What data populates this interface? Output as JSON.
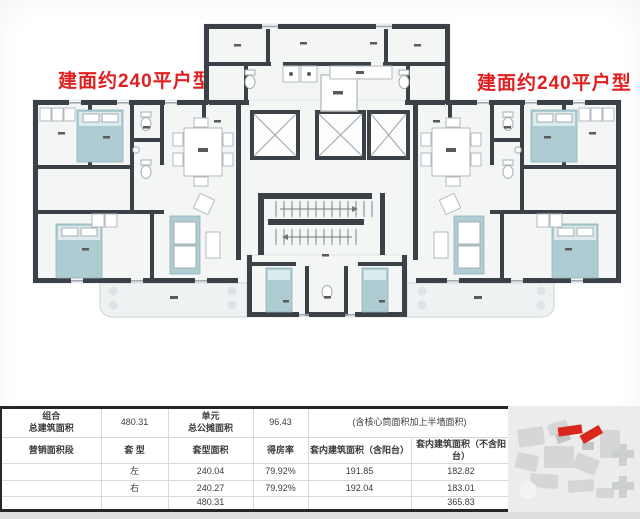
{
  "colors": {
    "accent_red": "#e02020",
    "wall": "#3b4147",
    "furniture_teal": "#aecdd2"
  },
  "floorplan": {
    "label_left": "建面约240平户型",
    "label_right": "建面约240平户型"
  },
  "table": {
    "combo_label": "组合\n总建筑面积",
    "combo_value": "480.31",
    "unit_label": "单元\n总公摊面积",
    "unit_value": "96.43",
    "note": "(含核心筒面积加上半墙面积)",
    "headers": [
      "营销面积段",
      "套 型",
      "套型面积",
      "得房率",
      "套内建筑面积（含阳台）",
      "套内建筑面积（不含阳台）"
    ],
    "rows": [
      {
        "segment": "",
        "type": "左",
        "area": "240.04",
        "rate": "79.92%",
        "with_balcony": "191.85",
        "no_balcony": "182.82"
      },
      {
        "segment": "",
        "type": "右",
        "area": "240.27",
        "rate": "79.92%",
        "with_balcony": "192.04",
        "no_balcony": "183.01"
      },
      {
        "segment": "",
        "type": "",
        "area": "480.31",
        "rate": "",
        "with_balcony": "",
        "no_balcony": "365.83"
      }
    ]
  }
}
